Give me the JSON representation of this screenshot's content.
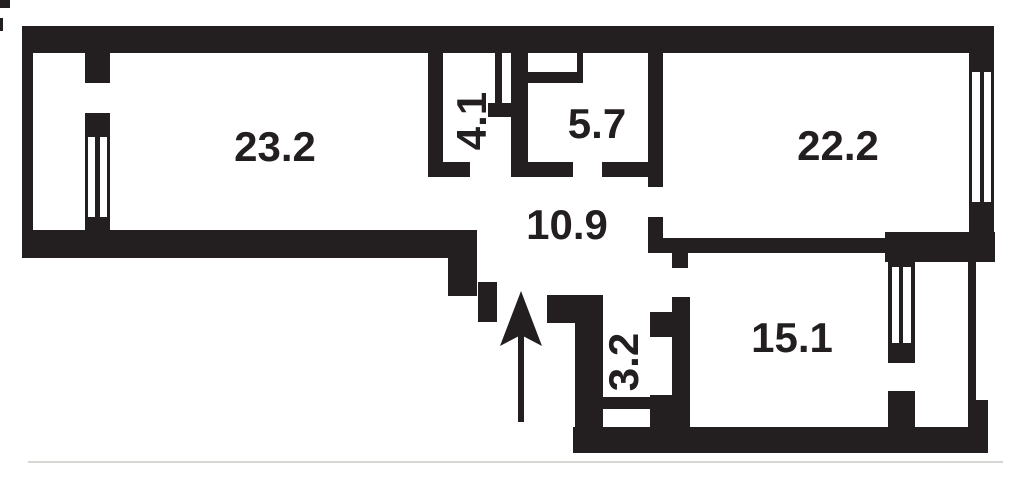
{
  "plan": {
    "width": 1024,
    "height": 481,
    "background_color": "#ffffff",
    "wall_color": "#231f20",
    "label_color": "#231f20"
  },
  "rooms": [
    {
      "label": "23.2",
      "x": 275,
      "y": 147,
      "rot": 0
    },
    {
      "label": "4.1",
      "x": 472,
      "y": 121,
      "rot": -90
    },
    {
      "label": "5.7",
      "x": 597,
      "y": 124,
      "rot": 0
    },
    {
      "label": "10.9",
      "x": 567,
      "y": 225,
      "rot": 0
    },
    {
      "label": "22.2",
      "x": 838,
      "y": 146,
      "rot": 0
    },
    {
      "label": "3.2",
      "x": 624,
      "y": 362,
      "rot": -90
    },
    {
      "label": "15.1",
      "x": 792,
      "y": 338,
      "rot": 0
    }
  ],
  "walls": [
    [
      22,
      26,
      972,
      27
    ],
    [
      22,
      53,
      11,
      179
    ],
    [
      85,
      53,
      25,
      30
    ],
    [
      85,
      113,
      25,
      119
    ],
    [
      22,
      230,
      455,
      28
    ],
    [
      448,
      256,
      29,
      40
    ],
    [
      478,
      282,
      19,
      40
    ],
    [
      428,
      53,
      15,
      109
    ],
    [
      428,
      162,
      42,
      15
    ],
    [
      495,
      53,
      7,
      50
    ],
    [
      511,
      53,
      17,
      109
    ],
    [
      488,
      103,
      40,
      14
    ],
    [
      528,
      72,
      55,
      11
    ],
    [
      577,
      53,
      6,
      30
    ],
    [
      511,
      162,
      62,
      15
    ],
    [
      602,
      162,
      61,
      15
    ],
    [
      648,
      53,
      15,
      134
    ],
    [
      648,
      217,
      15,
      21
    ],
    [
      648,
      238,
      237,
      15
    ],
    [
      672,
      253,
      16,
      15
    ],
    [
      672,
      297,
      18,
      156
    ],
    [
      650,
      312,
      22,
      25
    ],
    [
      547,
      295,
      56,
      28
    ],
    [
      575,
      323,
      28,
      130
    ],
    [
      603,
      397,
      47,
      12
    ],
    [
      650,
      395,
      22,
      58
    ],
    [
      573,
      427,
      415,
      26
    ],
    [
      885,
      232,
      110,
      30
    ],
    [
      888,
      262,
      27,
      101
    ],
    [
      888,
      391,
      27,
      36
    ],
    [
      969,
      53,
      25,
      179
    ],
    [
      968,
      262,
      8,
      143
    ],
    [
      968,
      400,
      20,
      27
    ]
  ],
  "windows": [
    [
      88,
      137,
      7,
      80
    ],
    [
      100,
      137,
      7,
      80
    ],
    [
      972,
      72,
      8,
      130
    ],
    [
      984,
      72,
      7,
      130
    ],
    [
      892,
      267,
      7,
      76
    ],
    [
      903,
      267,
      8,
      76
    ]
  ],
  "artifacts": [
    {
      "x": 0,
      "y": 0,
      "w": 10,
      "h": 8,
      "color": "#231f20"
    },
    {
      "x": 0,
      "y": 18,
      "w": 3,
      "h": 13,
      "color": "#231f20"
    },
    {
      "x": 28,
      "y": 461,
      "w": 975,
      "h": 2,
      "color": "#d8d6d3"
    }
  ],
  "entrance_arrow": {
    "tip_x": 521,
    "tip_y": 291,
    "half_width": 21,
    "base_y": 346,
    "notch_y": 335,
    "shaft_width": 6,
    "shaft_bottom_y": 422
  }
}
